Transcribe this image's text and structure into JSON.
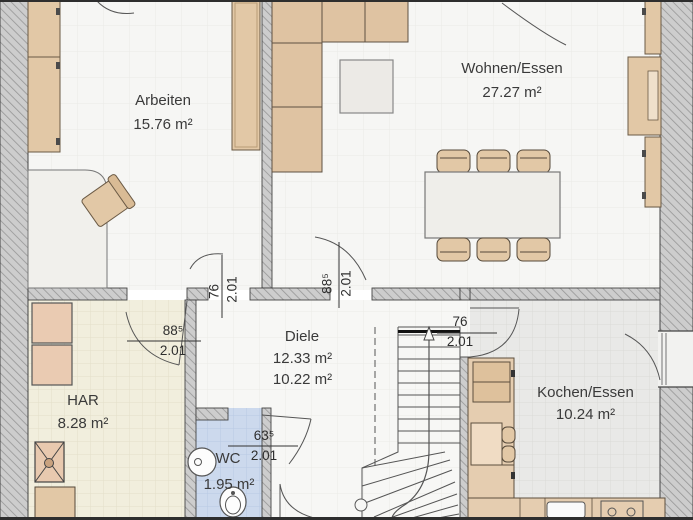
{
  "plan": {
    "rooms": {
      "arbeiten": {
        "name": "Arbeiten",
        "area": "15.76 m²"
      },
      "wohnen": {
        "name": "Wohnen/Essen",
        "area": "27.27 m²"
      },
      "diele": {
        "name": "Diele",
        "area_upper": "12.33 m²",
        "area_lower": "10.22 m²"
      },
      "har": {
        "name": "HAR",
        "area": "8.28 m²"
      },
      "wc": {
        "name": "WC",
        "area": "1.95 m²"
      },
      "kochen": {
        "name": "Kochen/Essen",
        "area": "10.24 m²"
      }
    },
    "door_dims": {
      "arbeiten_diele": {
        "w": "76",
        "h": "2.01"
      },
      "wohnen_diele": {
        "w": "88⁵",
        "h": "2.01"
      },
      "har_diele": {
        "w": "88⁵",
        "h": "2.01"
      },
      "kochen_diele": {
        "w": "76",
        "h": "2.01"
      },
      "wc_diele": {
        "w": "63⁵",
        "h": "2.01"
      }
    },
    "colors": {
      "wall_hatch_base": "#cdcdcd",
      "wall_hatch_line": "#969696",
      "furniture_tan": "#e2c8a6",
      "har_floor": "#f1eedd",
      "wc_floor": "#ccd9ed",
      "kochen_floor": "#e9e9e7",
      "living_floor": "#f6f6f4",
      "outline": "#444444"
    }
  }
}
